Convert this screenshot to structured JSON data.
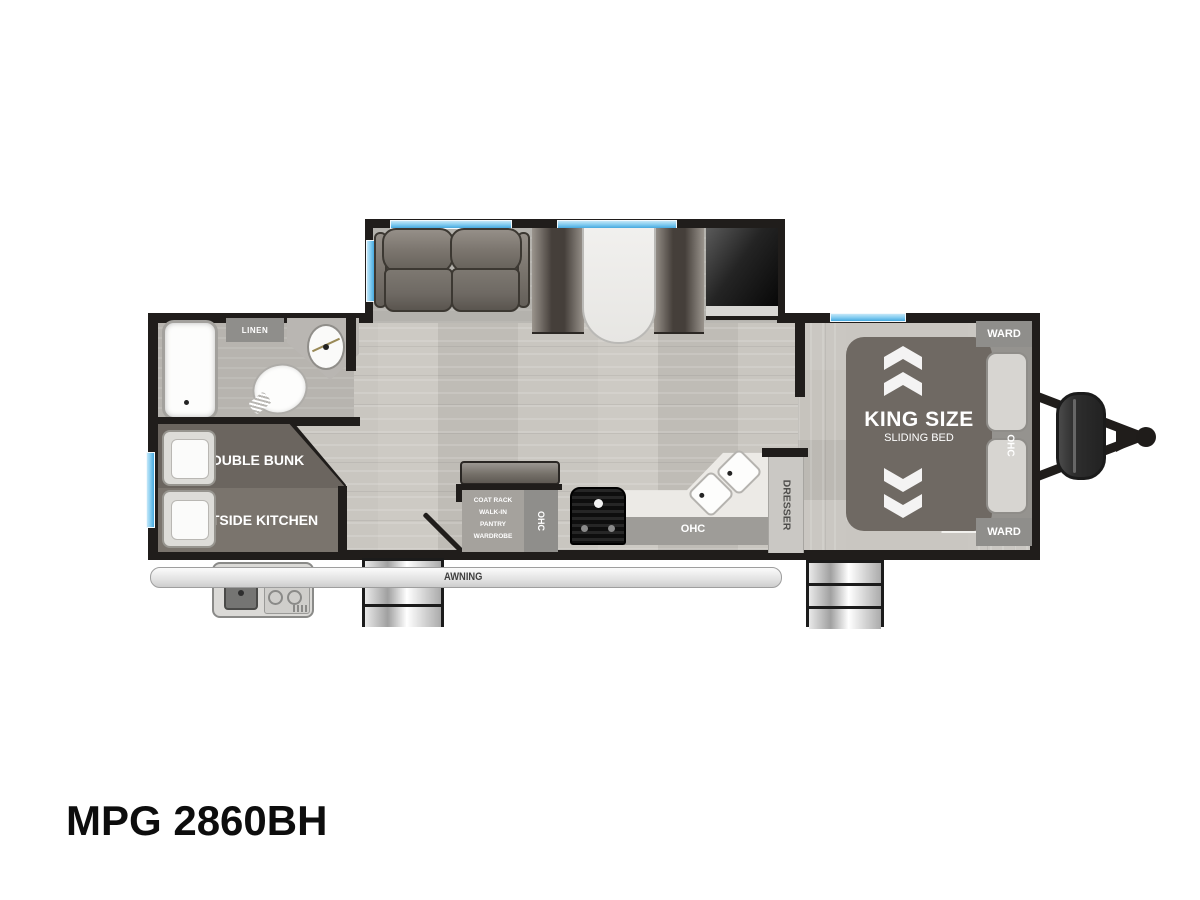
{
  "title": "MPG 2860BH",
  "floorplan": {
    "labels": {
      "linen": "LINEN",
      "double_bunk": "DOUBLE BUNK",
      "outside_kitchen": "OUTSIDE KITCHEN",
      "pantry1": "COAT RACK",
      "pantry2": "WALK-IN",
      "pantry3": "PANTRY",
      "pantry4": "WARDROBE",
      "ohc": "OHC",
      "dresser": "DRESSER",
      "ward": "WARD",
      "king_size": "KING SIZE",
      "sliding_bed": "SLIDING BED",
      "awning": "AWNING"
    },
    "colors": {
      "wall": "#201d1b",
      "floor_main": "#c9c6c0",
      "floor_bedroom": "#c6c3bd",
      "floor_bath": "#b7b4af",
      "floor_slide": "#b4b2ad",
      "furniture_dark": "#6f6963",
      "label_bg": "#8f8e8b",
      "window_blue": "#7ec9ef",
      "counter": "#eceae6",
      "ohc_band": "#9e9c98"
    },
    "features": [
      "sofa",
      "booth-dinette",
      "entertainment-center",
      "bathtub",
      "toilet",
      "corner-sink",
      "linen-cabinet",
      "double-bunk",
      "outside-kitchen-griddle",
      "range-stove",
      "walk-in-pantry",
      "double-sink",
      "dresser",
      "king-sliding-bed",
      "wardrobes",
      "overhead-cabinets",
      "propane-tanks",
      "a-frame-hitch",
      "entry-steps",
      "awning-rail"
    ]
  }
}
